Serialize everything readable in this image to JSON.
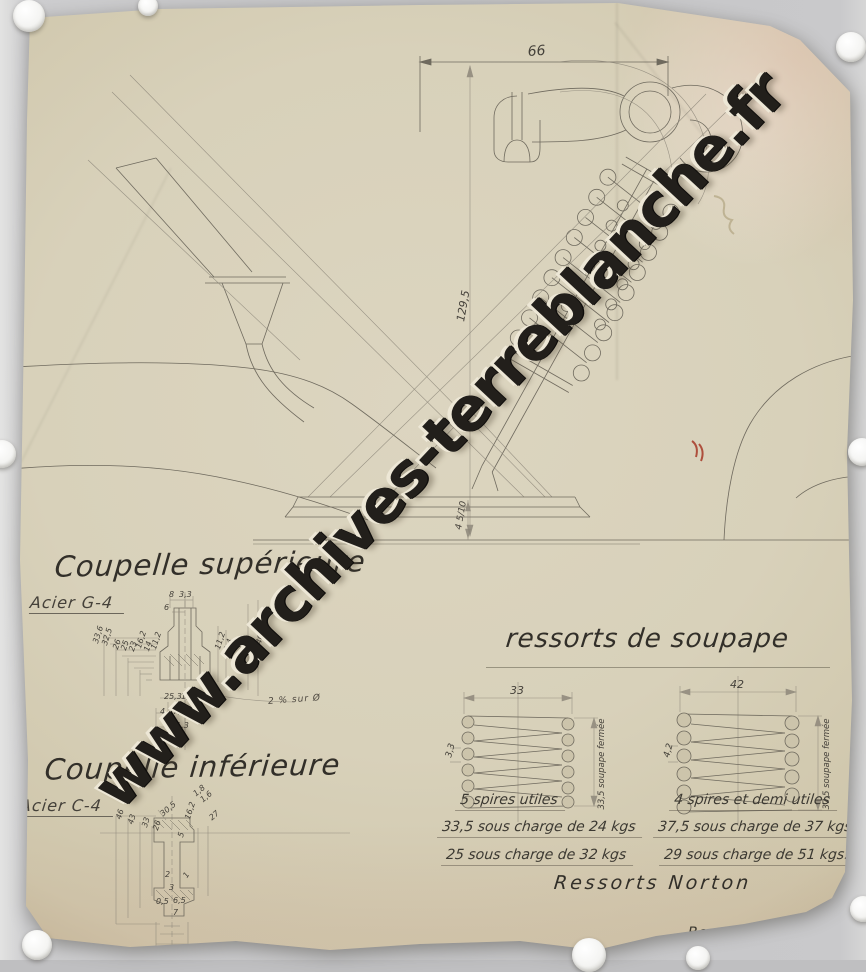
{
  "watermark": "www.archives-terreblanche.fr",
  "main_drawing": {
    "dim_top_width": "66",
    "dim_height": "129,5",
    "dim_base_gap": "4 5/10"
  },
  "coupelle_superieure": {
    "title": "Coupelle supérieure",
    "material": "Acier G-4",
    "note": "2 % sur Ø",
    "labels": [
      {
        "t": "33,6",
        "x": 62,
        "y": 97,
        "r": -72
      },
      {
        "t": "32,5",
        "x": 71,
        "y": 99,
        "r": -72
      },
      {
        "t": "26",
        "x": 82,
        "y": 103,
        "r": -72
      },
      {
        "t": "25",
        "x": 90,
        "y": 104,
        "r": -72
      },
      {
        "t": "23",
        "x": 98,
        "y": 105,
        "r": -72
      },
      {
        "t": "16,2",
        "x": 105,
        "y": 102,
        "r": -72
      },
      {
        "t": "14",
        "x": 113,
        "y": 105,
        "r": -72
      },
      {
        "t": "11,2",
        "x": 120,
        "y": 103,
        "r": -72
      },
      {
        "t": "8",
        "x": 139,
        "y": 46,
        "r": 0
      },
      {
        "t": "3,3",
        "x": 149,
        "y": 46,
        "r": 0
      },
      {
        "t": "6",
        "x": 134,
        "y": 59,
        "r": 0
      },
      {
        "t": "11,2",
        "x": 184,
        "y": 103,
        "r": -72
      },
      {
        "t": "2,4",
        "x": 193,
        "y": 105,
        "r": -72
      },
      {
        "t": "31",
        "x": 215,
        "y": 100,
        "r": -72
      },
      {
        "t": "40",
        "x": 225,
        "y": 98,
        "r": -72
      },
      {
        "t": "25,3",
        "x": 134,
        "y": 148,
        "r": 0
      },
      {
        "t": "1,8",
        "x": 151,
        "y": 148,
        "r": 0
      },
      {
        "t": "4",
        "x": 130,
        "y": 163,
        "r": 0
      },
      {
        "t": "7,3",
        "x": 143,
        "y": 163,
        "r": 0
      },
      {
        "t": "11,3",
        "x": 141,
        "y": 177,
        "r": 0
      }
    ]
  },
  "coupelle_inferieure": {
    "title": "Coupelle inférieure",
    "material": "Acier C-4",
    "labels": [
      {
        "t": "46",
        "x": 95,
        "y": 70,
        "r": -72
      },
      {
        "t": "43",
        "x": 107,
        "y": 75,
        "r": -72
      },
      {
        "t": "33",
        "x": 121,
        "y": 78,
        "r": -72
      },
      {
        "t": "26",
        "x": 132,
        "y": 81,
        "r": -72
      },
      {
        "t": "5",
        "x": 157,
        "y": 88,
        "r": -72
      },
      {
        "t": "30,5",
        "x": 139,
        "y": 64,
        "r": -40
      },
      {
        "t": "16,2",
        "x": 164,
        "y": 70,
        "r": -72
      },
      {
        "t": "1,8",
        "x": 172,
        "y": 44,
        "r": -40
      },
      {
        "t": "1,6",
        "x": 179,
        "y": 50,
        "r": -40
      },
      {
        "t": "27",
        "x": 188,
        "y": 68,
        "r": -40
      },
      {
        "t": "2",
        "x": 145,
        "y": 123,
        "r": 0
      },
      {
        "t": "1",
        "x": 162,
        "y": 127,
        "r": -55
      },
      {
        "t": "3",
        "x": 149,
        "y": 136,
        "r": 0
      },
      {
        "t": "0,5",
        "x": 136,
        "y": 150,
        "r": 0
      },
      {
        "t": "6,5",
        "x": 153,
        "y": 149,
        "r": 0
      },
      {
        "t": "7",
        "x": 153,
        "y": 161,
        "r": 0
      }
    ]
  },
  "ressorts": {
    "title": "ressorts de soupape",
    "left_spring": {
      "dim_width": "33",
      "dim_wire": "3,3",
      "dim_closed": "33,5 soupape fermée",
      "notes": [
        "5 spires utiles",
        "33,5 sous charge de 24 kgs",
        "25  sous charge de 32 kgs"
      ]
    },
    "right_spring": {
      "dim_width": "42",
      "dim_wire": "4,2",
      "dim_closed": "37,5 soupape fermée",
      "notes": [
        "4 spires et demi utiles",
        "37,5 sous charge de 37 kgs.",
        "29  sous charge de 51 kgs."
      ]
    },
    "caption": "Ressorts Norton"
  },
  "signature": "Beaulieu: SEE. 16-1-34"
}
